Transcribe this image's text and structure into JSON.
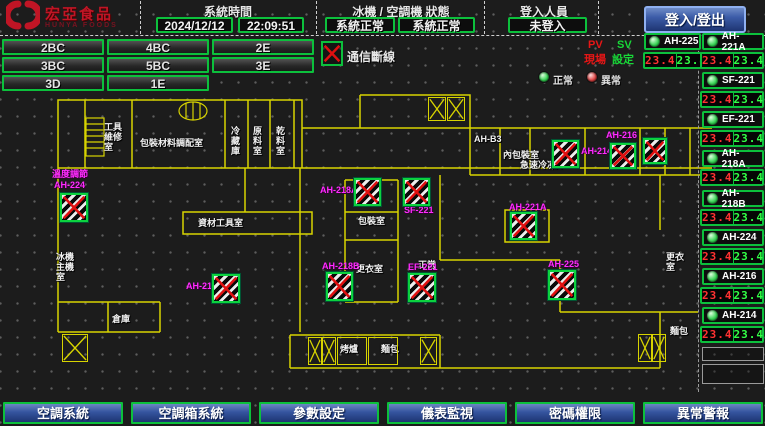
{
  "brand": {
    "name_zh": "宏亞食品",
    "name_en": "HUNYA FOODS"
  },
  "header": {
    "system_time_label": "系統時間",
    "date": "2024/12/12",
    "time": "22:09:51",
    "machine_status_label": "冰機 / 空調機 狀態",
    "chiller_status": "系統正常",
    "ac_status": "系統正常",
    "login_label": "登入人員",
    "login_status": "未登入",
    "login_button_label": "登入/登出"
  },
  "floor_buttons": [
    "2BC",
    "4BC",
    "2E",
    "3BC",
    "5BC",
    "3E",
    "3D",
    "1E"
  ],
  "legend": {
    "comm_fail_label": "通信斷線",
    "pv_label": "PV",
    "sv_label": "SV",
    "pv_sub_label": "現場",
    "sv_sub_label": "設定",
    "normal_label": "正常",
    "abnormal_label": "異常"
  },
  "sidebar": {
    "top_unit": {
      "name": "AH-225",
      "pv": "23.4",
      "sv": "23.4"
    },
    "units": [
      {
        "name": "AH-221A",
        "pv": "23.4",
        "sv": "23.4"
      },
      {
        "name": "SF-221",
        "pv": "23.4",
        "sv": "23.4"
      },
      {
        "name": "EF-221",
        "pv": "23.4",
        "sv": "23.4"
      },
      {
        "name": "AH-218A",
        "pv": "23.4",
        "sv": "23.4"
      },
      {
        "name": "AH-218B",
        "pv": "23.4",
        "sv": "23.4"
      },
      {
        "name": "AH-224",
        "pv": "23.4",
        "sv": "23.4"
      },
      {
        "name": "AH-216",
        "pv": "23.4",
        "sv": "23.4"
      },
      {
        "name": "AH-214",
        "pv": "23.4",
        "sv": "23.4"
      }
    ]
  },
  "plan": {
    "rooms": [
      "工具 維修室",
      "包裝材料調配室",
      "冷藏庫",
      "原料室",
      "乾料室",
      "AH-B3",
      "內包裝室",
      "急速冷凍庫",
      "資材工具室",
      "包裝室",
      "更衣室",
      "正常",
      "冰機 主機室",
      "烤爐",
      "麵包",
      "倉庫",
      "更衣室",
      "麵包"
    ],
    "units": [
      {
        "label": "AH-224",
        "sub": "溫度調節"
      },
      {
        "label": "AH-213",
        "sub": ""
      },
      {
        "label": "AH-218A",
        "sub": ""
      },
      {
        "label": "SF-221",
        "sub": ""
      },
      {
        "label": "AH-218B",
        "sub": ""
      },
      {
        "label": "EF-221",
        "sub": ""
      },
      {
        "label": "AH-221A",
        "sub": ""
      },
      {
        "label": "AH-225",
        "sub": ""
      },
      {
        "label": "AH-214",
        "sub": ""
      },
      {
        "label": "AH-216",
        "sub": ""
      }
    ]
  },
  "nav_buttons": [
    "空調系統",
    "空調箱系統",
    "參數設定",
    "儀表監視",
    "密碼權限",
    "異常警報"
  ],
  "colors": {
    "accent_green": "#0cc03c",
    "alarm_red": "#e01010",
    "magenta": "#ff2bff",
    "wall_yellow": "#d8d400",
    "seg_red": "#ff3232",
    "seg_green": "#32ff46",
    "button_blue": "#31509a"
  }
}
